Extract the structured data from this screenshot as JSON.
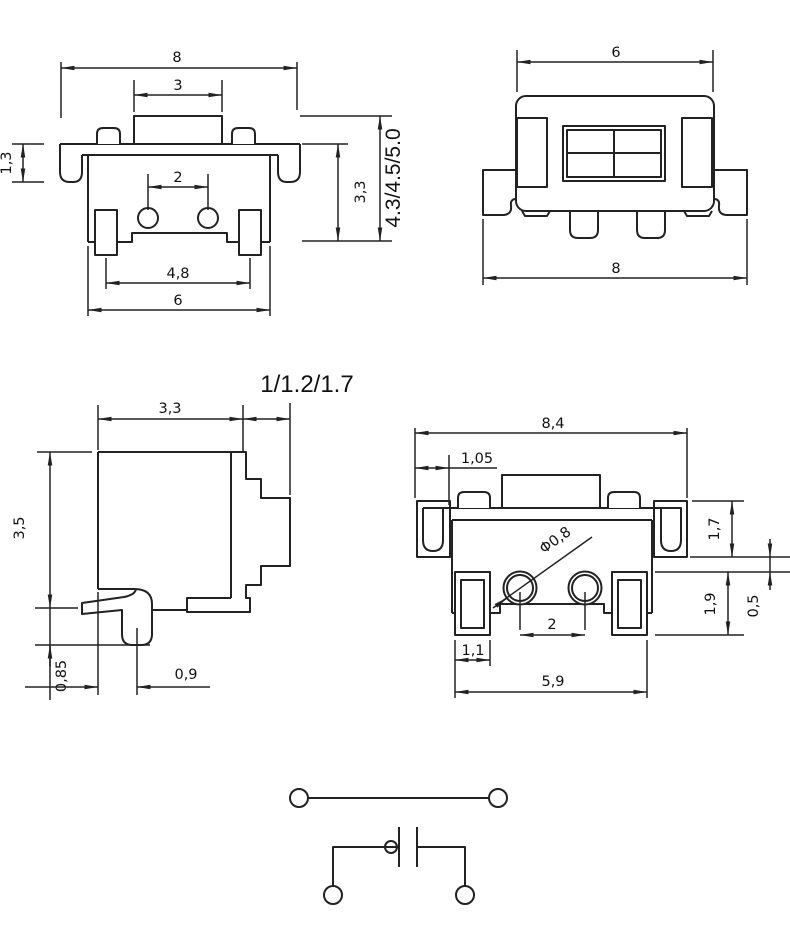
{
  "drawing": {
    "background_color": "#ffffff",
    "line_color": "#222222",
    "views": {
      "front_view": {
        "dims": {
          "overall_width": "8",
          "button_width": "3",
          "flange_height": "1,3",
          "contact_spacing": "2",
          "body_height": "3,3",
          "terminal_pitch": "4,8",
          "base_width": "6",
          "total_height_variants": "4.3/4.5/5.0"
        }
      },
      "rear_view": {
        "dims": {
          "body_width": "6",
          "overall_width": "8"
        }
      },
      "side_view": {
        "dims": {
          "body_depth": "3,3",
          "stem_length_variants": "1/1.2/1.7",
          "body_height": "3,5",
          "foot_offset": "0,9",
          "lead_seating_height": "0,85"
        }
      },
      "bottom_view": {
        "dims": {
          "overall_width": "8,4",
          "edge_to_pad": "1,05",
          "hole_diameter": "Φ0,8",
          "bracket_depth": "1,7",
          "pad_depth": "1,9",
          "step_height": "0,5",
          "pad_width": "1,1",
          "hole_spacing": "2",
          "pad_span": "5,9"
        }
      }
    }
  }
}
